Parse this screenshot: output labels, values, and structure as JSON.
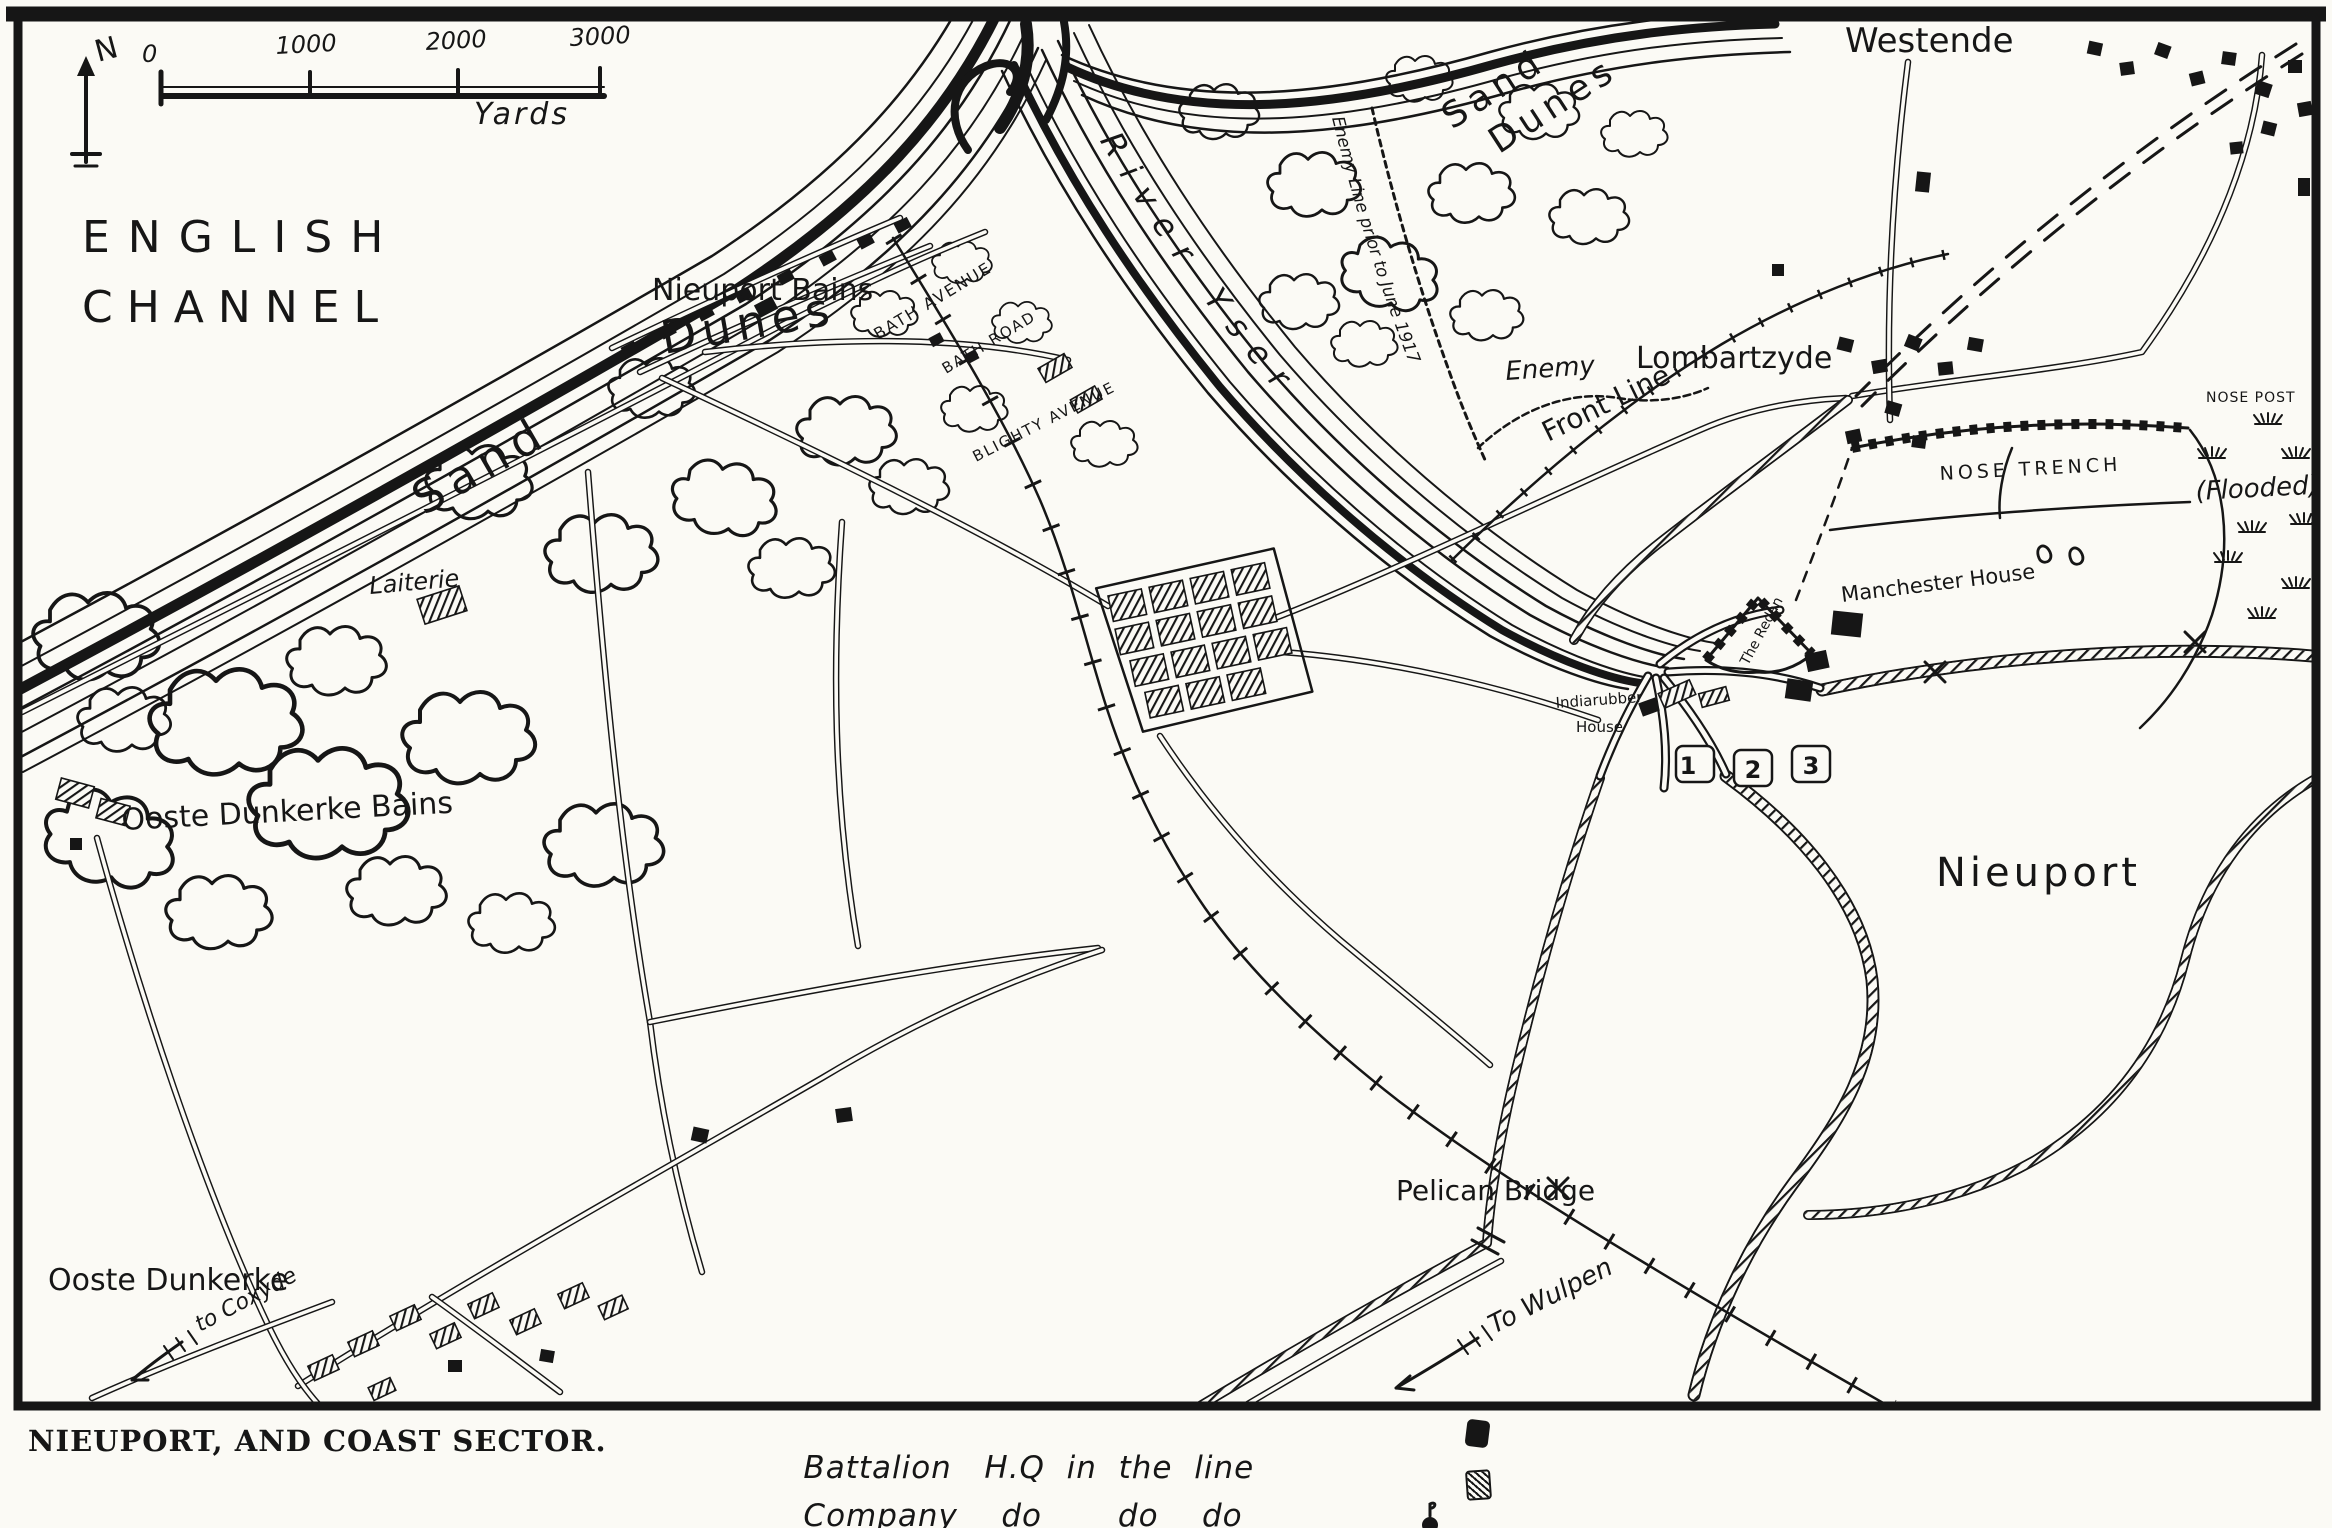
{
  "map": {
    "caption": "NIEUPORT, AND COAST SECTOR.",
    "compass_north": "N",
    "scale": {
      "tick0": "0",
      "tick1": "1000",
      "tick2": "2000",
      "tick3": "3000",
      "unit": "Yards"
    },
    "sea": {
      "line1": "ENGLISH",
      "line2": "CHANNEL"
    },
    "labels": {
      "westende": "Westende",
      "sand_dunes_ne_1": "Sand",
      "sand_dunes_ne_2": "Dunes",
      "enemy_line_note": "Enemy Line prior to June 1917",
      "front_line": "Front Line",
      "lombartzyde": "Lombartzyde",
      "enemy": "Enemy",
      "nose_trench": "NOSE TRENCH",
      "nose_post": "NOSE POST",
      "flooded": "(Flooded)",
      "river_yser": "River Yser",
      "nieuport_bains": "Nieuport Bains",
      "bath_avenue": "BATH AVENUE",
      "bath_road": "BATH ROAD",
      "blighty_avenue": "BLIGHTY AVENUE",
      "dunes_mid": "Dunes",
      "sand_mid": "Sand",
      "laiterie": "Laiterie",
      "ooste_dunkerke_bains": "Ooste Dunkerke Bains",
      "manchester_house": "Manchester House",
      "the_redan": "The Redan",
      "indiarubber_house_1": "Indiarubber",
      "indiarubber_house_2": "House",
      "lock_1": "1",
      "lock_2": "2",
      "lock_3": "3",
      "nieuport": "Nieuport",
      "pelican_bridge": "Pelican Bridge",
      "to_wulpen": "To Wulpen",
      "ooste_dunkerke": "Ooste Dunkerke",
      "to_coxyde": "to Coxyde"
    },
    "legend": {
      "row1_label": "Battalion   H.Q  in  the  line",
      "row2_label": "Company    do       do    do"
    }
  }
}
